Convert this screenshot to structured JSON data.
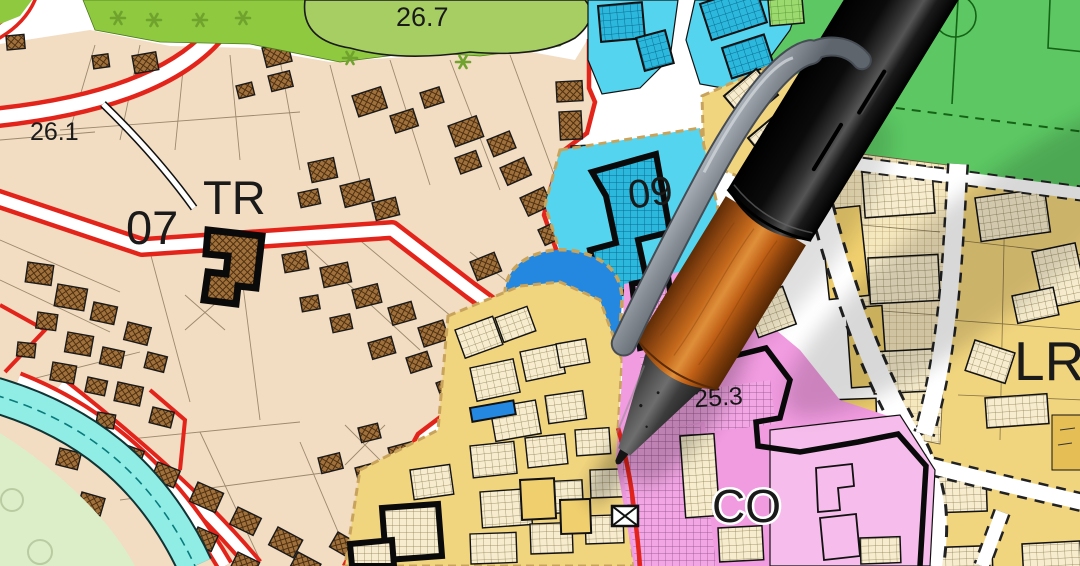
{
  "map": {
    "labels": {
      "a26_1": "26.1",
      "z07": "07",
      "tr": "TR",
      "a26_7": "26.7",
      "z09": "09",
      "p": "P",
      "a25_3": "25.3",
      "co": "CO",
      "lr": "LR"
    },
    "colors": {
      "parcel_beige": "#F2DCC2",
      "building_brown": "#A0713A",
      "boundary_red": "#E3241B",
      "grass_green": "#8FC93F",
      "area_26_7_green": "#A6CE63",
      "sports_field_green": "#5CC763",
      "zone_cyan": "#55D4EF",
      "building_cyan": "#2BB8DC",
      "parking_blue": "#2488E0",
      "zone_yellow": "#F1D47E",
      "building_cream": "#F7EDCE",
      "zone_pink": "#F19BE0",
      "zone_pink_light": "#F6BCEB",
      "river_cyan": "#8FEDE6",
      "meadow_green": "#DCEEC8",
      "zone_border_tan": "#C8A35C"
    },
    "symbols": [
      "tree-asterisk",
      "river-hatching",
      "sports-field-markings",
      "cross-parcel-mark"
    ]
  },
  "pen": {
    "object": "ballpoint-pen",
    "barrel_color": "#C4691C",
    "cap_color": "#111111",
    "clip_color": "#9AA0A8",
    "grip_color": "#4A4A4A"
  }
}
